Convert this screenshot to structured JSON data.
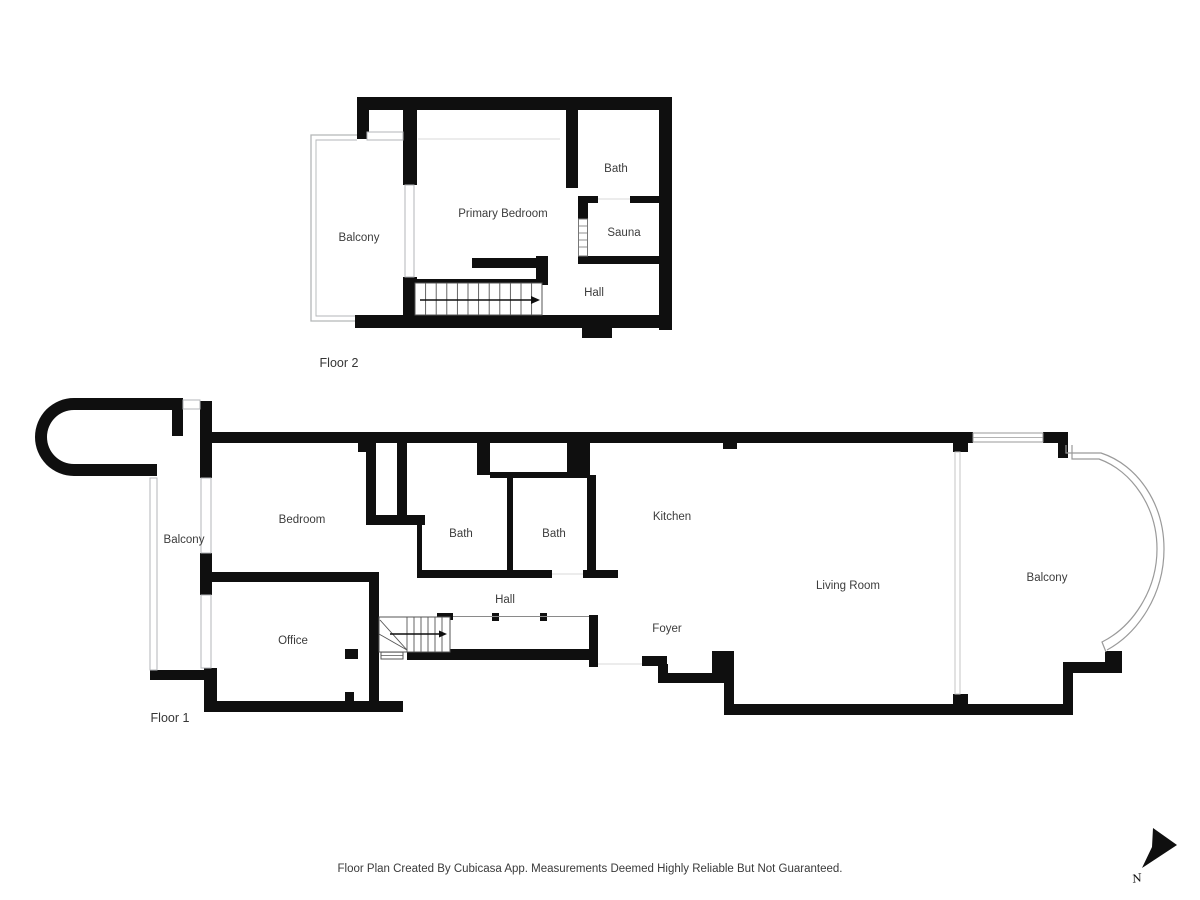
{
  "floor2": {
    "label": "Floor 2",
    "rooms": {
      "balcony": "Balcony",
      "primary_bedroom": "Primary Bedroom",
      "bath": "Bath",
      "sauna": "Sauna",
      "hall": "Hall"
    }
  },
  "floor1": {
    "label": "Floor 1",
    "rooms": {
      "balcony_west": "Balcony",
      "bedroom": "Bedroom",
      "bath_a": "Bath",
      "bath_b": "Bath",
      "kitchen": "Kitchen",
      "hall": "Hall",
      "office": "Office",
      "foyer": "Foyer",
      "living_room": "Living Room",
      "balcony_east": "Balcony"
    }
  },
  "footer": {
    "disclaimer": "Floor Plan Created By Cubicasa App. Measurements Deemed Highly Reliable But Not Guaranteed."
  },
  "compass": {
    "north_label": "N"
  },
  "colors": {
    "wall": "#0f0f0f",
    "label": "#3c3c3c",
    "railing": "#b3b6b8"
  }
}
